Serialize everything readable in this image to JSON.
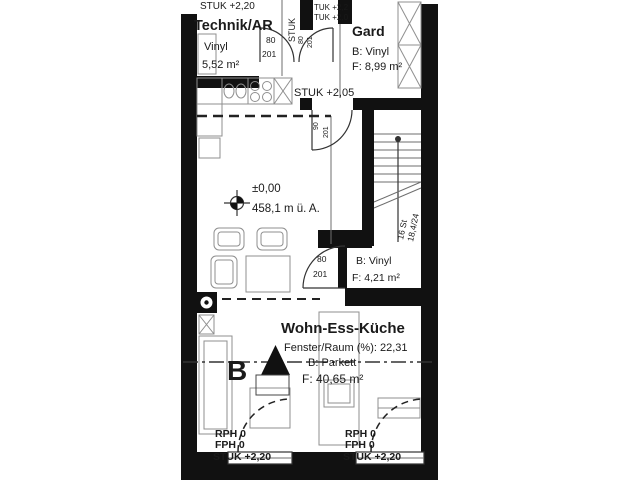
{
  "meta": {
    "type": "architectural floor plan"
  },
  "colors": {
    "wall": "#111111",
    "line": "#6e6e6e",
    "furniture": "#8f8f8f",
    "text": "#1a1a1a",
    "background": "#ffffff"
  },
  "labels": {
    "top": {
      "stuk_left": "STUK +2,20",
      "stuk_vertical": "STUK",
      "door1_stuk": "TUK +2,2",
      "door2_stuk": "TUK +2,0"
    },
    "rooms": {
      "technik": {
        "name": "Technik/AR",
        "floor": "Vinyl",
        "area": "5,52 m²"
      },
      "gard": {
        "name": "Gard",
        "floor": "B: Vinyl",
        "area": "F: 8,99 m²"
      },
      "wc": {
        "floor": "B: Vinyl",
        "area": "F: 4,21 m²"
      },
      "wohn": {
        "name": "Wohn-Ess-Küche",
        "fenster": "Fenster/Raum (%): 22,31",
        "floor": "B: Parkett",
        "area": "F: 40,65 m²"
      }
    },
    "level": {
      "zero": "±0,00",
      "altitude": "458,1 m ü. A."
    },
    "stuk_mid": "STUK +2,05",
    "stairs": {
      "steps": "16 St",
      "ratio": "18,4/24"
    },
    "doors": {
      "door1": {
        "w": "80",
        "h": "201"
      },
      "door2": {
        "w": "80",
        "h": "201"
      },
      "door3": {
        "w": "90",
        "h": "201"
      },
      "wc": {
        "w": "80",
        "h": "201"
      }
    },
    "window_left": {
      "rph": "RPH 0",
      "fph": "FPH 0",
      "stuk": "STUK +2,20"
    },
    "window_right": {
      "rph": "RPH 0",
      "fph": "FPH 0",
      "stuk": "STUK +2,20"
    },
    "section": {
      "letter": "B"
    }
  }
}
